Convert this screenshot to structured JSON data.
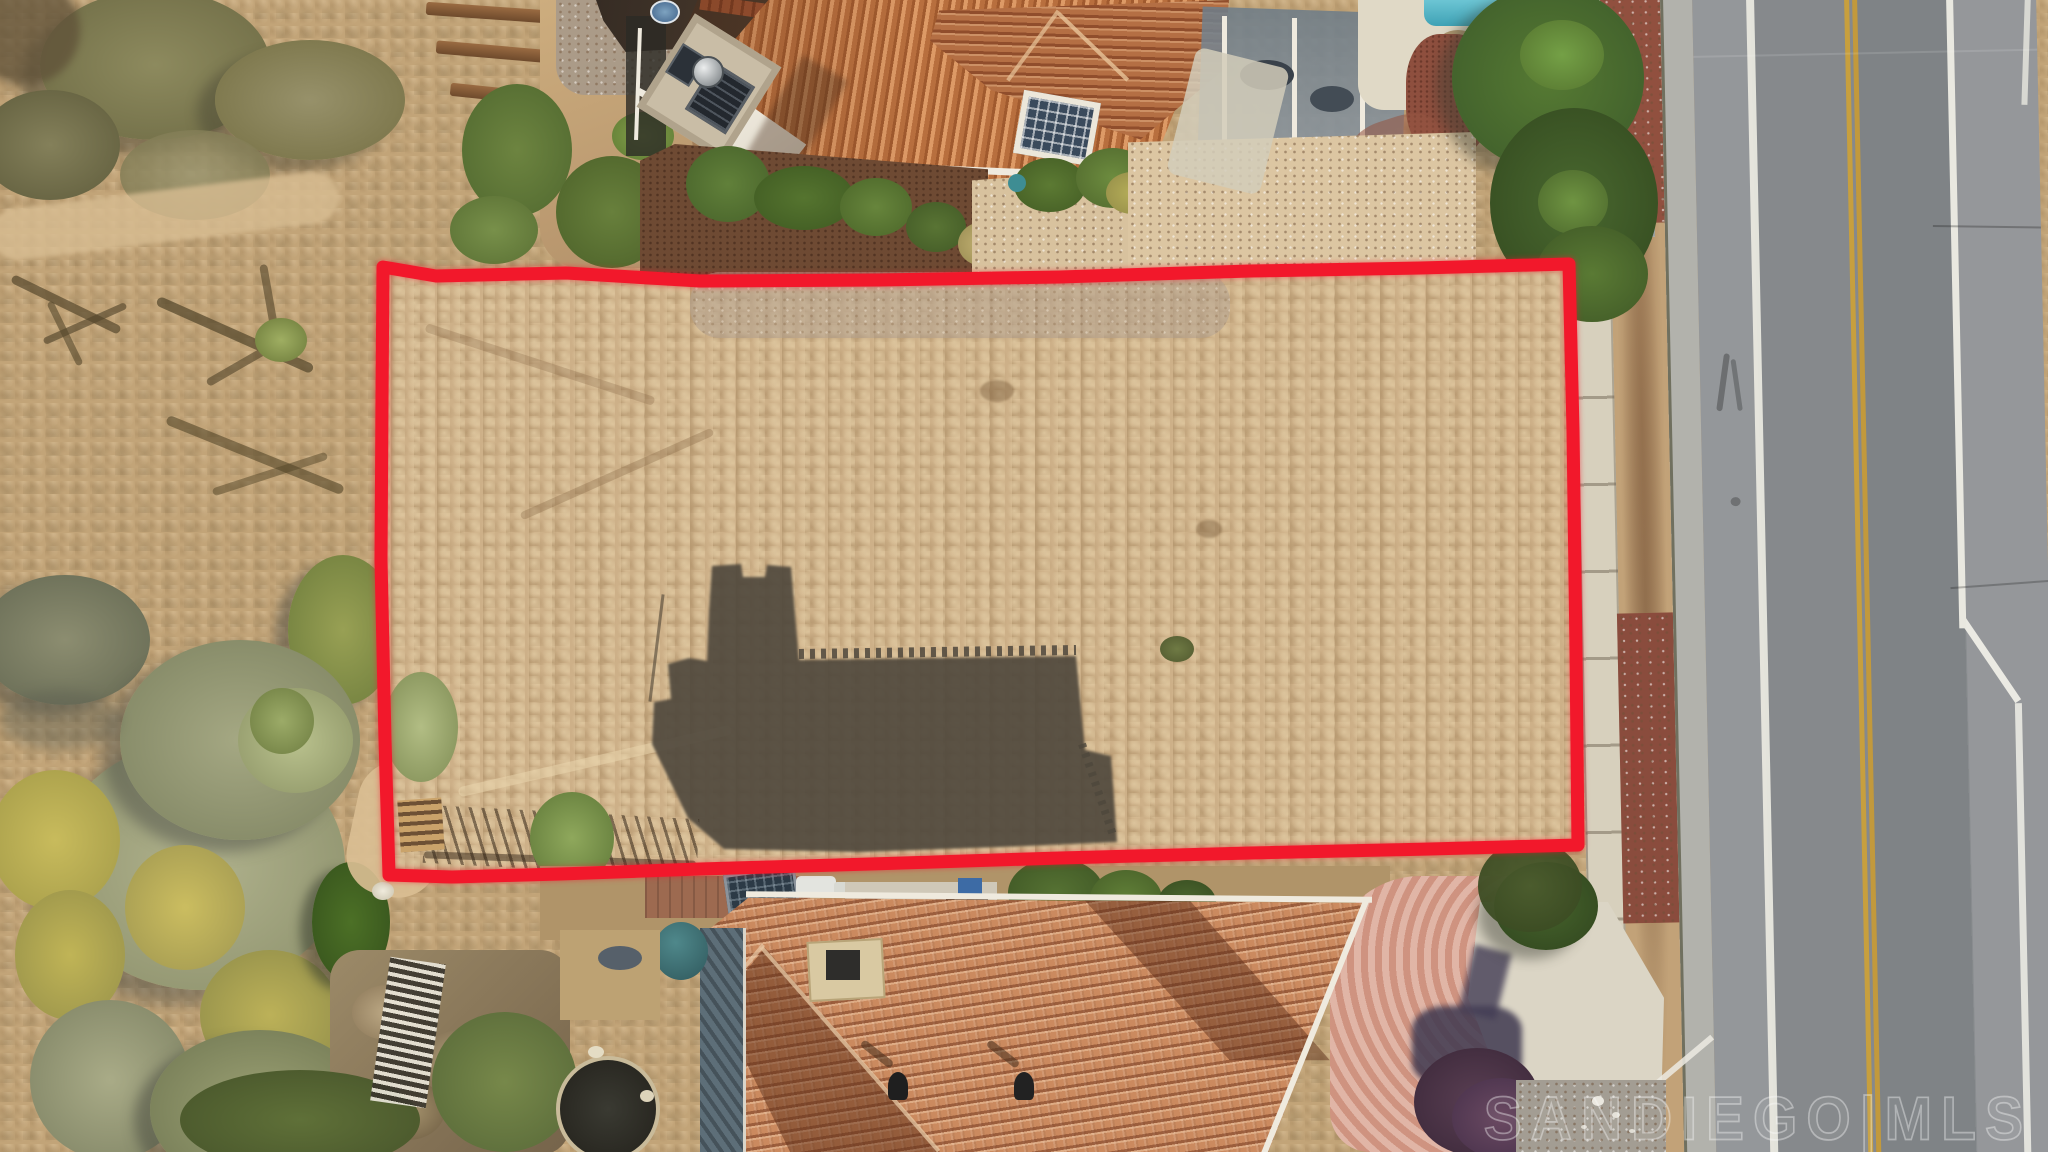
{
  "watermark": {
    "text": "SANDIEGO|MLS"
  },
  "boundary": {
    "points": "383,267 436,276 566,273 700,281 880,280 1060,277 1250,271 1420,268 1569,264 1573,430 1576,650 1578,845 1430,849 1250,853 1060,858 870,864 700,869 560,874 452,877 389,875 385,740 381,560 382,400",
    "stroke_color": "#f2182b",
    "stroke_width": 13
  },
  "palette": {
    "lot_dirt": "#cdb088",
    "scrub_dirt": "#bf9f74",
    "boundary_red": "#f2182b",
    "corrugated_roof": "#c27844",
    "spanish_tile_roof": "#cb8a5f",
    "asphalt": "#898c8f",
    "center_line_yellow": "#c79f3e",
    "lane_line_white": "#eceae2",
    "sidewalk_concrete": "#d7d0bd",
    "paver_driveway": "#d9a390",
    "pool_water": "#53b7c8",
    "sage_vegetation": "#a9ac8b",
    "juniper_vegetation": "#3f5c28",
    "cast_shadow": "#4e473c"
  },
  "scene": {
    "description": "Aerial drone photo of a vacant dirt lot outlined in red, between tile-roof houses, beside a two-lane road with a double yellow center line"
  }
}
